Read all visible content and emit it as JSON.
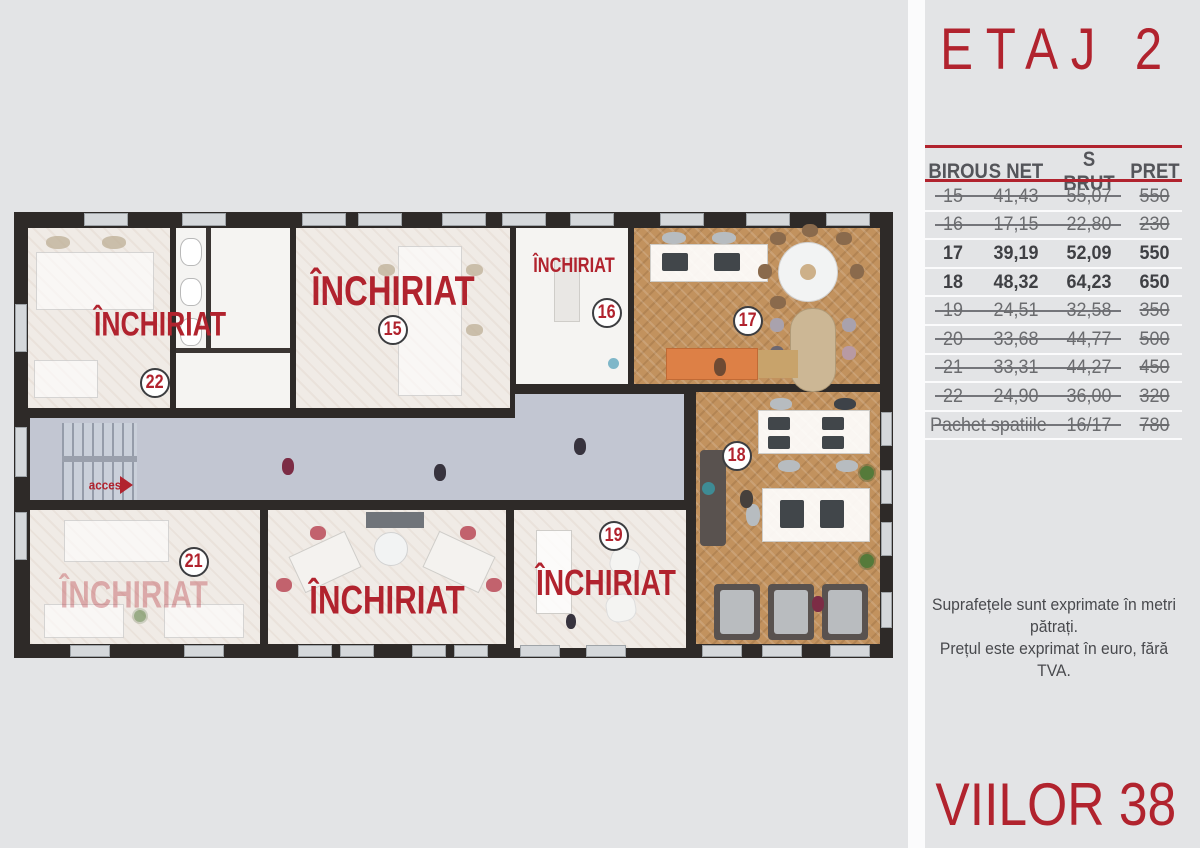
{
  "colors": {
    "accent": "#b1232e",
    "background": "#e3e4e6",
    "wall": "#2e2a28"
  },
  "panel": {
    "title": "ETAJ 2",
    "table": {
      "headers": [
        "BIROU",
        "S NET",
        "S BRUT",
        "PRET"
      ],
      "rows": [
        {
          "birou": "15",
          "net": "41,43",
          "brut": "55,07",
          "pret": "550",
          "status": "sold"
        },
        {
          "birou": "16",
          "net": "17,15",
          "brut": "22,80",
          "pret": "230",
          "status": "sold"
        },
        {
          "birou": "17",
          "net": "39,19",
          "brut": "52,09",
          "pret": "550",
          "status": "available"
        },
        {
          "birou": "18",
          "net": "48,32",
          "brut": "64,23",
          "pret": "650",
          "status": "available"
        },
        {
          "birou": "19",
          "net": "24,51",
          "brut": "32,58",
          "pret": "350",
          "status": "sold"
        },
        {
          "birou": "20",
          "net": "33,68",
          "brut": "44,77",
          "pret": "500",
          "status": "sold"
        },
        {
          "birou": "21",
          "net": "33,31",
          "brut": "44,27",
          "pret": "450",
          "status": "sold"
        },
        {
          "birou": "22",
          "net": "24,90",
          "brut": "36,00",
          "pret": "320",
          "status": "sold"
        },
        {
          "label": "Pachet spatiile",
          "brut": "16/17",
          "pret": "780",
          "status": "sold"
        }
      ]
    },
    "note_line1": "Suprafețele sunt exprimate în metri pătrați.",
    "note_line2": "Prețul este exprimat în euro, fără TVA.",
    "building": "VIILOR 38"
  },
  "plan": {
    "rented_label": "ÎNCHIRIAT",
    "access_label": "acces",
    "rooms": {
      "r15": "15",
      "r16": "16",
      "r17": "17",
      "r18": "18",
      "r19": "19",
      "r21": "21",
      "r22": "22"
    }
  }
}
